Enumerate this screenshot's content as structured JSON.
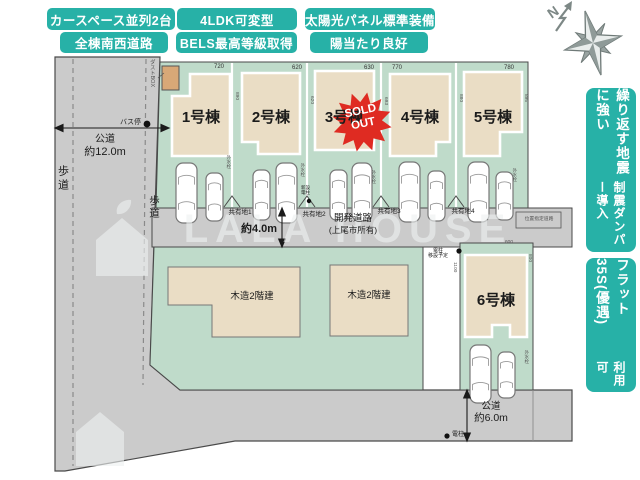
{
  "colors": {
    "teal": "#27b1a7",
    "lot_green": "#bfdbca",
    "house_beige": "#eaddc5",
    "road_gray": "#cbcbcb",
    "sold_red": "#df2b22"
  },
  "top_badges": [
    {
      "label": "カースペース並列2台"
    },
    {
      "label": "4LDK可変型"
    },
    {
      "label": "太陽光パネル標準装備"
    },
    {
      "label": "全棟南西道路"
    },
    {
      "label": "BELS最高等級取得"
    },
    {
      "label": "陽当たり良好"
    }
  ],
  "side_badges": [
    {
      "main": "繰り返す地震に強い",
      "sub": "制震ダンパー導入"
    },
    {
      "main": "フラット35S(優遇)",
      "sub": "利用可"
    }
  ],
  "compass": {
    "north_letter": "N"
  },
  "plan": {
    "lots": [
      {
        "name": "1号棟",
        "frontage": "720"
      },
      {
        "name": "2号棟",
        "frontage": "620"
      },
      {
        "name": "3号棟",
        "frontage": "630"
      },
      {
        "name": "4号棟",
        "frontage": "770"
      },
      {
        "name": "5号棟",
        "frontage": "780"
      },
      {
        "name": "6号棟"
      }
    ],
    "sold_badge": {
      "line1": "SOLD",
      "line2": "OUT"
    },
    "shared_areas": [
      "共有地1",
      "共有地2",
      "共有地3",
      "共有地4"
    ],
    "neighbor_buildings": [
      {
        "label": "木造2階建"
      },
      {
        "label": "木造2階建"
      }
    ],
    "roads": {
      "west": {
        "type": "公道",
        "width": "約12.0m",
        "sidewalk": "歩道",
        "sidewalk2": "歩道",
        "bus_stop": "バス停",
        "dust_box": "ダストBOX"
      },
      "center": {
        "name": "開発道路",
        "owner": "(上尾市所有)",
        "width": "約4.0m"
      },
      "south": {
        "type": "公道",
        "width": "約6.0m",
        "pole": "電柱"
      },
      "east": {
        "name": "位置指定道路"
      }
    },
    "micro_labels": {
      "outdoor_tap": "外水栓",
      "pole_relocate_line1": "電柱",
      "pole_relocate_line2": "移設予定",
      "new_pole_line1": "新設",
      "new_pole_line2": "電柱",
      "side_dims": [
        "890",
        "620",
        "693",
        "880",
        "895"
      ],
      "lot6_dims": {
        "left": "1100",
        "right": "800",
        "top": "600"
      }
    }
  },
  "watermark": {
    "text": "LALA HOUSE"
  }
}
